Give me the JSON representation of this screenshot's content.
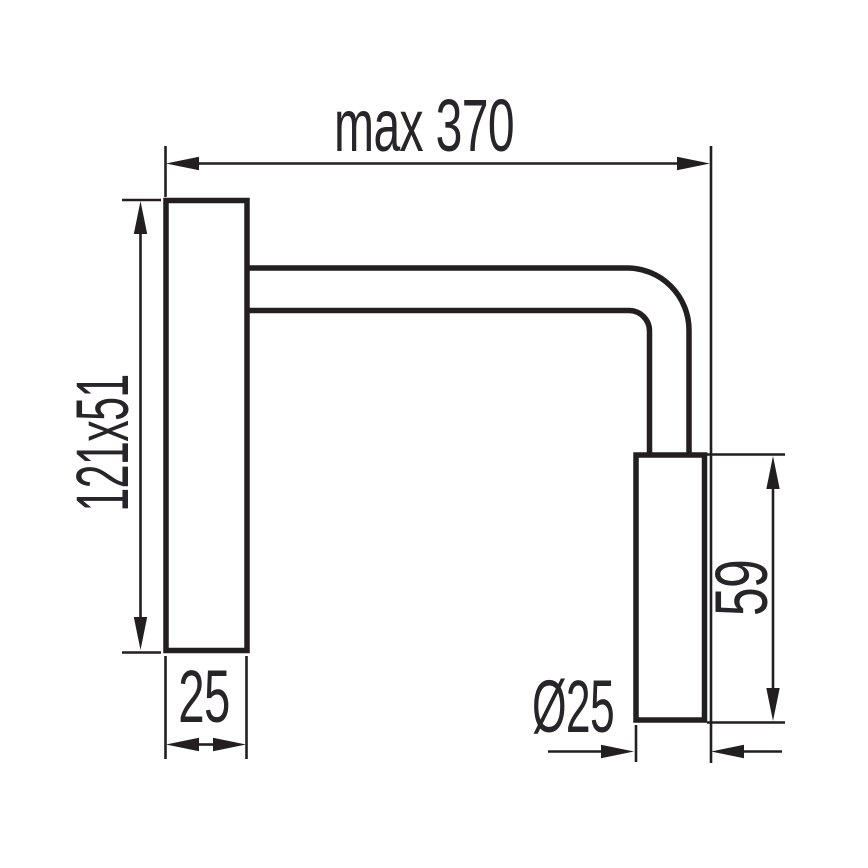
{
  "drawing": {
    "line_color": "#231f20",
    "background_color": "#ffffff",
    "labels": {
      "max_width": "max 370",
      "plate_size": "121x51",
      "plate_depth": "25",
      "head_length": "59",
      "head_diameter": "Ø25"
    }
  }
}
